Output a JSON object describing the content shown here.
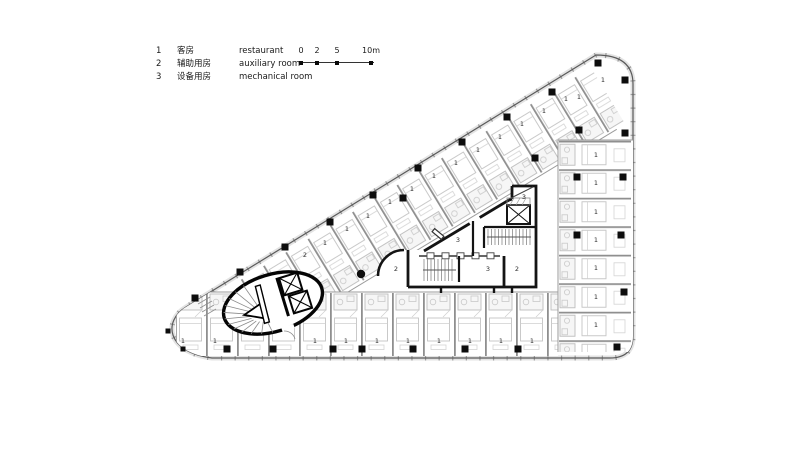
{
  "legend": {
    "items": [
      {
        "num": "1",
        "zh": "客房",
        "en": "restaurant"
      },
      {
        "num": "2",
        "zh": "辅助用房",
        "en": "auxiliary room"
      },
      {
        "num": "3",
        "zh": "设备用房",
        "en": "mechanical room"
      }
    ]
  },
  "scale_bar": {
    "labels": [
      "0",
      "2",
      "5",
      "10m"
    ]
  },
  "plan": {
    "colors": {
      "wall": "#141414",
      "partition": "#8f8f8f",
      "furniture": "#c4c4c4",
      "column": "#0d0d0d"
    },
    "room_labels": [
      {
        "t": "1",
        "x": 183,
        "y": 341
      },
      {
        "t": "1",
        "x": 215,
        "y": 341
      },
      {
        "t": "1",
        "x": 315,
        "y": 341
      },
      {
        "t": "1",
        "x": 346,
        "y": 341
      },
      {
        "t": "1",
        "x": 377,
        "y": 341
      },
      {
        "t": "1",
        "x": 408,
        "y": 341
      },
      {
        "t": "1",
        "x": 439,
        "y": 341
      },
      {
        "t": "1",
        "x": 470,
        "y": 341
      },
      {
        "t": "1",
        "x": 501,
        "y": 341
      },
      {
        "t": "1",
        "x": 532,
        "y": 341
      },
      {
        "t": "1",
        "x": 596,
        "y": 155
      },
      {
        "t": "1",
        "x": 596,
        "y": 183
      },
      {
        "t": "1",
        "x": 596,
        "y": 212
      },
      {
        "t": "1",
        "x": 596,
        "y": 240
      },
      {
        "t": "1",
        "x": 596,
        "y": 268
      },
      {
        "t": "1",
        "x": 596,
        "y": 297
      },
      {
        "t": "1",
        "x": 596,
        "y": 325
      },
      {
        "t": "1",
        "x": 325,
        "y": 243
      },
      {
        "t": "1",
        "x": 347,
        "y": 229
      },
      {
        "t": "1",
        "x": 368,
        "y": 216
      },
      {
        "t": "1",
        "x": 390,
        "y": 202
      },
      {
        "t": "1",
        "x": 412,
        "y": 189
      },
      {
        "t": "1",
        "x": 434,
        "y": 176
      },
      {
        "t": "1",
        "x": 456,
        "y": 163
      },
      {
        "t": "1",
        "x": 478,
        "y": 150
      },
      {
        "t": "1",
        "x": 500,
        "y": 137
      },
      {
        "t": "1",
        "x": 522,
        "y": 124
      },
      {
        "t": "1",
        "x": 544,
        "y": 111
      },
      {
        "t": "1",
        "x": 566,
        "y": 99
      },
      {
        "t": "1",
        "x": 579,
        "y": 97
      },
      {
        "t": "1",
        "x": 603,
        "y": 80
      },
      {
        "t": "2",
        "x": 305,
        "y": 255
      },
      {
        "t": "2",
        "x": 396,
        "y": 269
      },
      {
        "t": "3",
        "x": 458,
        "y": 240
      },
      {
        "t": "3",
        "x": 488,
        "y": 269
      },
      {
        "t": "2",
        "x": 517,
        "y": 269
      },
      {
        "t": "3",
        "x": 524,
        "y": 197
      }
    ],
    "columns": [
      {
        "x": 227,
        "y": 349
      },
      {
        "x": 273,
        "y": 349
      },
      {
        "x": 333,
        "y": 349
      },
      {
        "x": 362,
        "y": 349
      },
      {
        "x": 413,
        "y": 349
      },
      {
        "x": 465,
        "y": 349
      },
      {
        "x": 518,
        "y": 349
      },
      {
        "x": 617,
        "y": 347
      },
      {
        "x": 625,
        "y": 80
      },
      {
        "x": 625,
        "y": 133
      },
      {
        "x": 623,
        "y": 177
      },
      {
        "x": 621,
        "y": 235
      },
      {
        "x": 624,
        "y": 292
      },
      {
        "x": 195,
        "y": 298
      },
      {
        "x": 240,
        "y": 272
      },
      {
        "x": 285,
        "y": 247
      },
      {
        "x": 330,
        "y": 222
      },
      {
        "x": 373,
        "y": 195
      },
      {
        "x": 418,
        "y": 168
      },
      {
        "x": 462,
        "y": 142
      },
      {
        "x": 507,
        "y": 117
      },
      {
        "x": 552,
        "y": 92
      },
      {
        "x": 598,
        "y": 63
      },
      {
        "x": 168,
        "y": 331,
        "s": 5
      },
      {
        "x": 183,
        "y": 349,
        "s": 5
      },
      {
        "x": 577,
        "y": 177
      },
      {
        "x": 577,
        "y": 235
      },
      {
        "x": 403,
        "y": 198
      },
      {
        "x": 535,
        "y": 158
      },
      {
        "x": 579,
        "y": 130
      }
    ],
    "round_columns": [
      {
        "x": 361,
        "y": 274
      }
    ]
  }
}
